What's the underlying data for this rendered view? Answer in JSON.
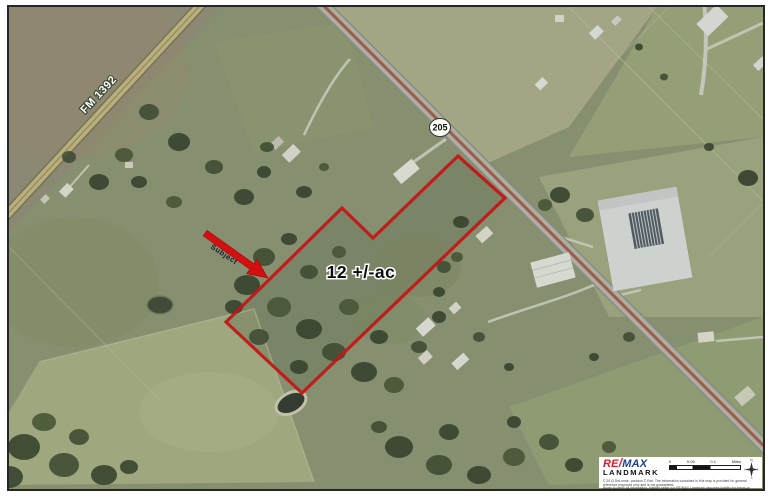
{
  "map": {
    "labels": {
      "fm_road": "FM 1392",
      "highway": "205",
      "acreage": "12 +/-ac",
      "subject_arrow": "Subject"
    },
    "colors": {
      "boundary_red": "#c31515",
      "arrow_red": "#d40f0f",
      "fm_road_fill": "#cabd85",
      "highway_fill": "#bcbcb4",
      "highway_stripe": "#a65a4a",
      "badge_fill": "#fdfdf6"
    }
  },
  "info_box": {
    "brand": {
      "re": "RE",
      "slash": "/",
      "max": "MAX",
      "name": "LANDMARK",
      "re_color": "#dc1c2e",
      "max_color": "#1c3f94"
    },
    "disclaimer_line1": "© 2013 DeLorme, portions © Esri. The information contained in this map is provided for general reference purposes only and is not guaranteed.",
    "disclaimer_line2": "Buyer to verify all information. Neither seller nor RE/MAX Landmark assumes liability for errors or omissions.",
    "scale_bar": {
      "zero": "0",
      "mid": "0.05",
      "end": "0.1",
      "unit": "Miles"
    },
    "compass": {
      "north": "N",
      "east": "E",
      "south": "S",
      "west": "W"
    }
  }
}
